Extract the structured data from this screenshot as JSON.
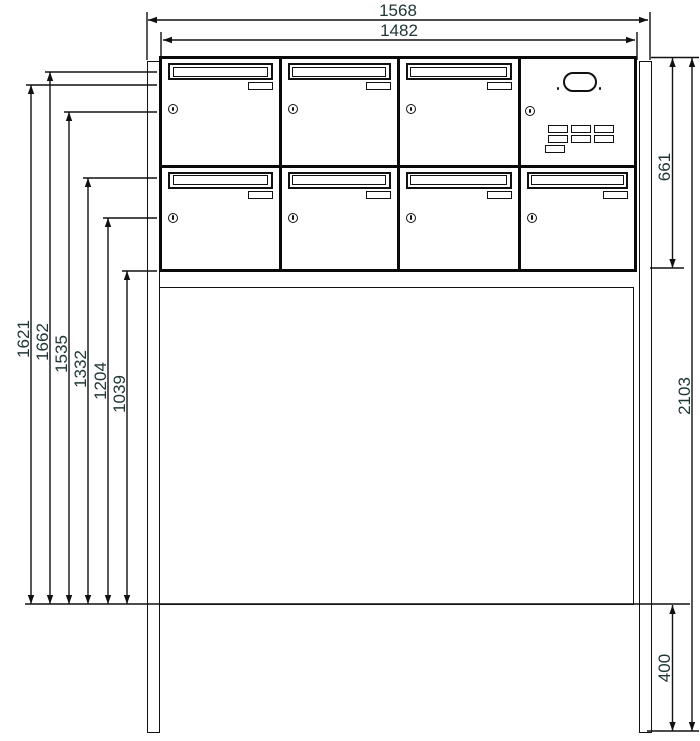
{
  "dims": {
    "top": [
      {
        "name": "overall-width",
        "value": "1568"
      },
      {
        "name": "cabinet-width",
        "value": "1482"
      }
    ],
    "left": [
      {
        "name": "height-1621",
        "value": "1621"
      },
      {
        "name": "height-1662",
        "value": "1662"
      },
      {
        "name": "height-1535",
        "value": "1535"
      },
      {
        "name": "height-1332",
        "value": "1332"
      },
      {
        "name": "height-1204",
        "value": "1204"
      },
      {
        "name": "height-1039",
        "value": "1039"
      }
    ],
    "right": [
      {
        "name": "cabinet-height",
        "value": "661"
      },
      {
        "name": "overall-height",
        "value": "2103"
      },
      {
        "name": "below-ground-depth",
        "value": "400"
      }
    ]
  },
  "colors": {
    "line": "#111111",
    "dimension_text": "#203636",
    "background": "#ffffff"
  }
}
